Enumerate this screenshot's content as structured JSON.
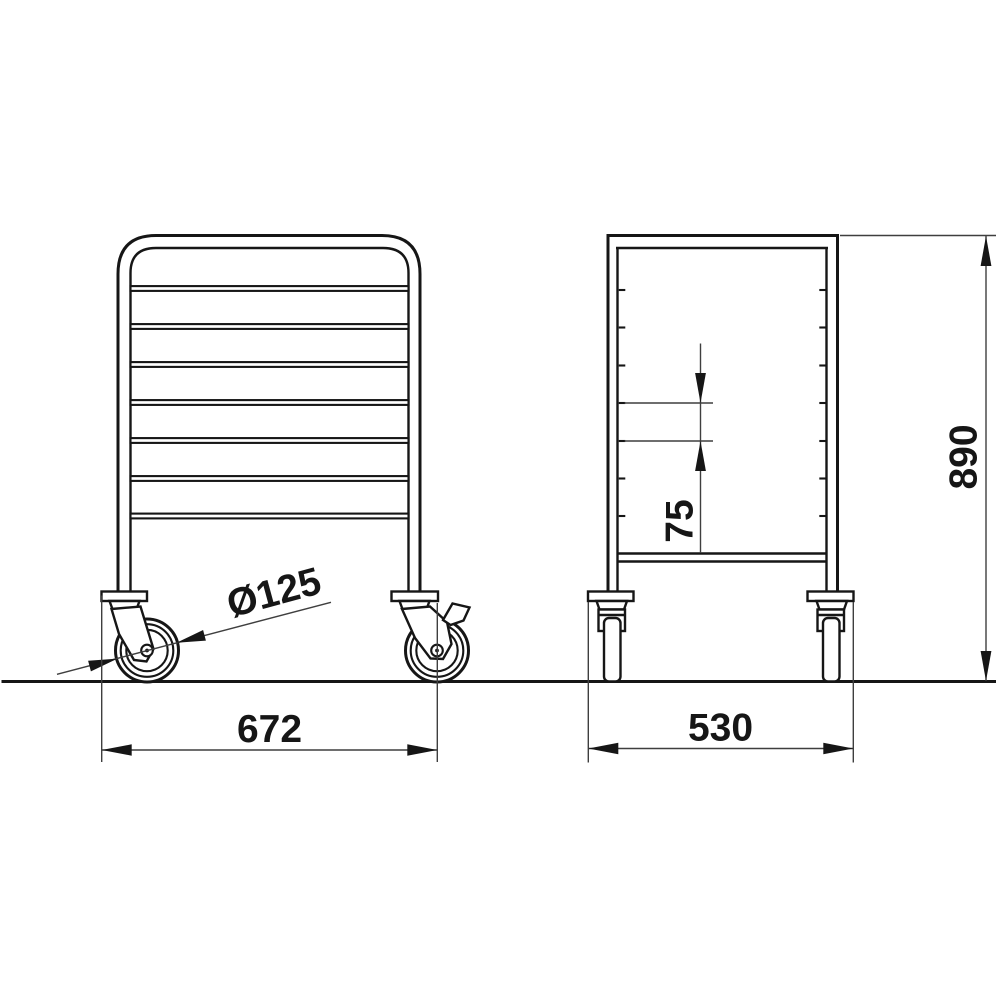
{
  "drawing": {
    "background": "#ffffff",
    "line_color": "#161616",
    "dimension_line_color": "#3f3f3f",
    "labels": {
      "overall_width": "672",
      "overall_depth": "530",
      "overall_height": "890",
      "slide_pitch": "75",
      "caster_diameter": "Ø125"
    },
    "front_view": {
      "rail_count": 7,
      "caster_left": "swivel-caster",
      "caster_right": "swivel-caster-with-brake"
    },
    "side_view": {
      "slide_tick_count": 7,
      "tray_lines": 2
    }
  }
}
